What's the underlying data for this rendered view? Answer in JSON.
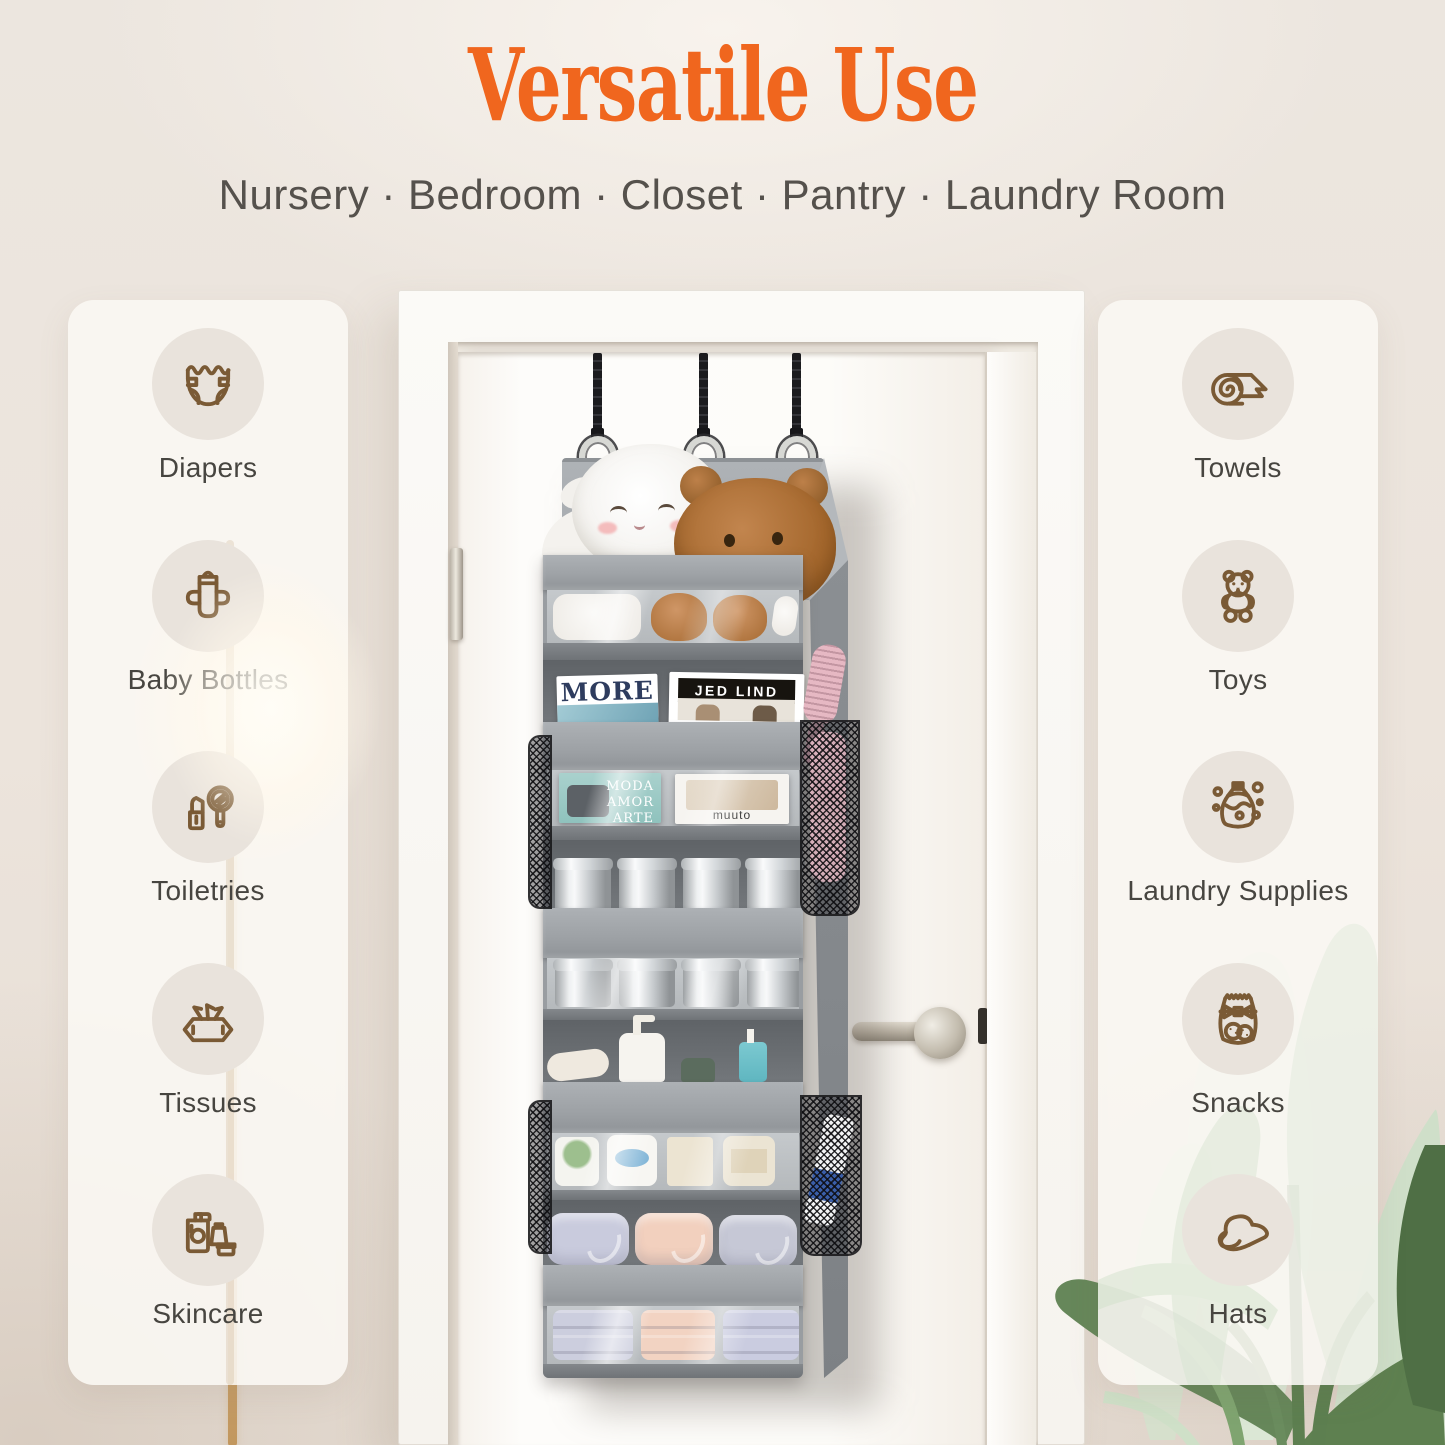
{
  "header": {
    "title": "Versatile Use",
    "subtitle": "Nursery · Bedroom · Closet · Pantry · Laundry Room"
  },
  "panels": {
    "left": {
      "items": [
        {
          "id": "diapers",
          "label": "Diapers",
          "icon": "diaper-icon"
        },
        {
          "id": "baby-bottles",
          "label": "Baby Bottles",
          "icon": "baby-bottle-icon"
        },
        {
          "id": "toiletries",
          "label": "Toiletries",
          "icon": "toiletries-icon"
        },
        {
          "id": "tissues",
          "label": "Tissues",
          "icon": "tissues-icon"
        },
        {
          "id": "skincare",
          "label": "Skincare",
          "icon": "skincare-icon"
        }
      ]
    },
    "right": {
      "items": [
        {
          "id": "towels",
          "label": "Towels",
          "icon": "towel-icon"
        },
        {
          "id": "toys",
          "label": "Toys",
          "icon": "teddy-bear-icon"
        },
        {
          "id": "laundry-supplies",
          "label": "Laundry Supplies",
          "icon": "laundry-detergent-icon"
        },
        {
          "id": "snacks",
          "label": "Snacks",
          "icon": "snack-bag-icon"
        },
        {
          "id": "hats",
          "label": "Hats",
          "icon": "sun-hat-icon"
        }
      ]
    }
  },
  "scene": {
    "magazines": {
      "more_title": "MORE",
      "jed_lind_title": "JED LIND",
      "moda_words": [
        "MODA",
        "AMOR",
        "ARTE"
      ],
      "muuto_title": "muuto"
    }
  },
  "colors": {
    "accent_orange": "#F0661E",
    "subtitle_gray": "#55514C",
    "icon_brown": "#7A5A35",
    "label_gray": "#474540",
    "organizer_gray": "#9CA0A4"
  }
}
